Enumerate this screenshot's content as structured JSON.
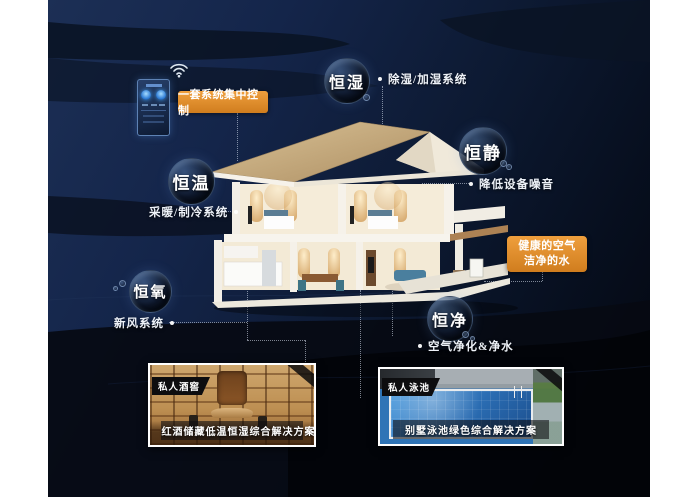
{
  "colors": {
    "accent_orange": "#dd8a2c",
    "bg_navy": "#14254a",
    "bubble_dark": "#0e1830",
    "photo_frame": "#ffffff"
  },
  "control": {
    "banner": "一套系统集中控制"
  },
  "bubbles": [
    {
      "label": "恒湿",
      "desc": "除湿/加湿系统"
    },
    {
      "label": "恒静",
      "desc": "降低设备噪音"
    },
    {
      "label": "恒温",
      "desc": "采暖/制冷系统"
    },
    {
      "label": "恒氧",
      "desc": "新风系统"
    },
    {
      "label": "恒净",
      "desc": "空气净化&净水"
    }
  ],
  "highlight_box": {
    "line1": "健康的空气",
    "line2": "洁净的水"
  },
  "photos": [
    {
      "tag": "私人酒窖",
      "caption": "红酒储藏低温恒湿综合解决方案"
    },
    {
      "tag": "私人泳池",
      "caption": "别墅泳池绿色综合解决方案"
    }
  ]
}
